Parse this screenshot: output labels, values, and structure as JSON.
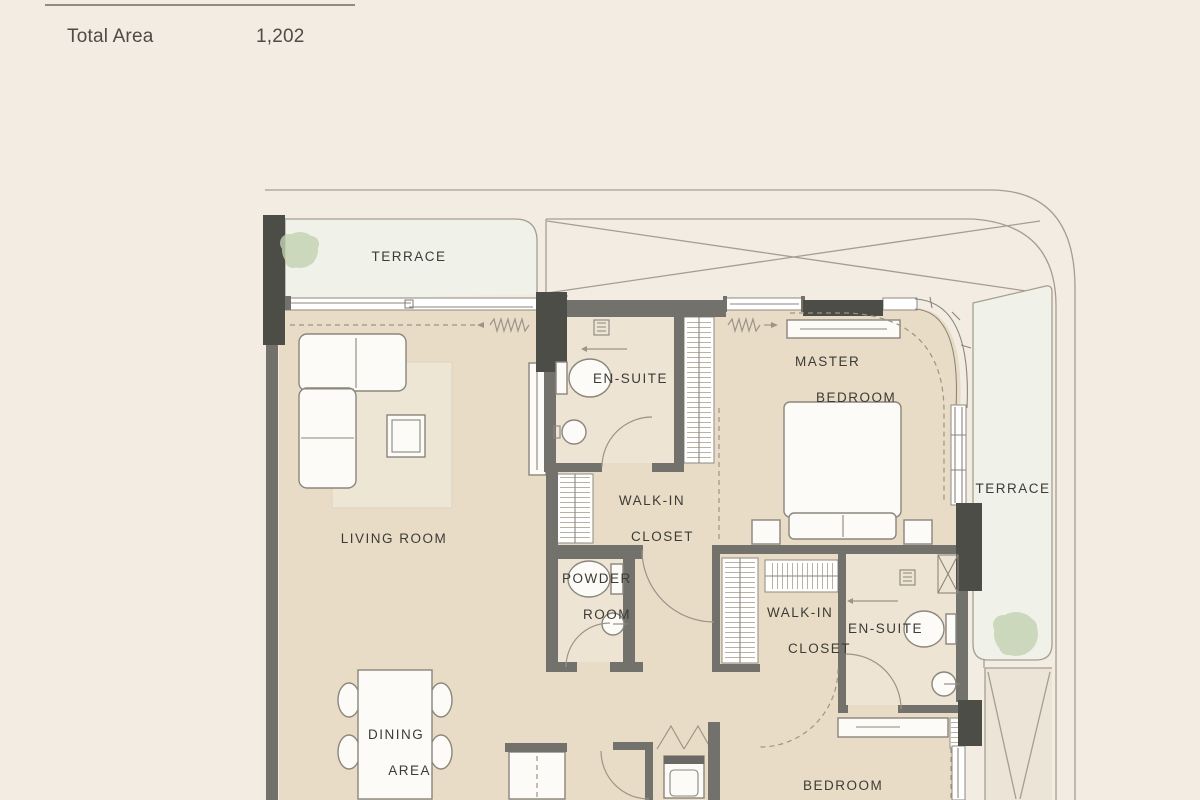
{
  "header": {
    "total_area_label": "Total Area",
    "total_area_value": "1,202"
  },
  "plan": {
    "labels": {
      "terrace_left": "TERRACE",
      "terrace_right": "TERRACE",
      "living_room": "LIVING ROOM",
      "ensuite_1": "EN-SUITE",
      "walk_in_1_line1": "WALK-IN",
      "walk_in_1_line2": "CLOSET",
      "master_line1": "MASTER",
      "master_line2": "BEDROOM",
      "powder_line1": "POWDER",
      "powder_line2": "ROOM",
      "walk_in_2_line1": "WALK-IN",
      "walk_in_2_line2": "CLOSET",
      "ensuite_2": "EN-SUITE",
      "dining_line1": "DINING",
      "dining_line2": "AREA",
      "bedroom": "BEDROOM"
    },
    "colors": {
      "bg": "#f2ece3",
      "wall": "#72716b",
      "wall_dark": "#4d4d48",
      "floor": "#e9dcc6",
      "floor_bath": "#eee4d4",
      "terrace": "#f0f1e8",
      "line": "#a59e90",
      "text": "#3c3b36",
      "tree": "#c3d2b1",
      "furniture_stroke": "#8b867c"
    }
  }
}
